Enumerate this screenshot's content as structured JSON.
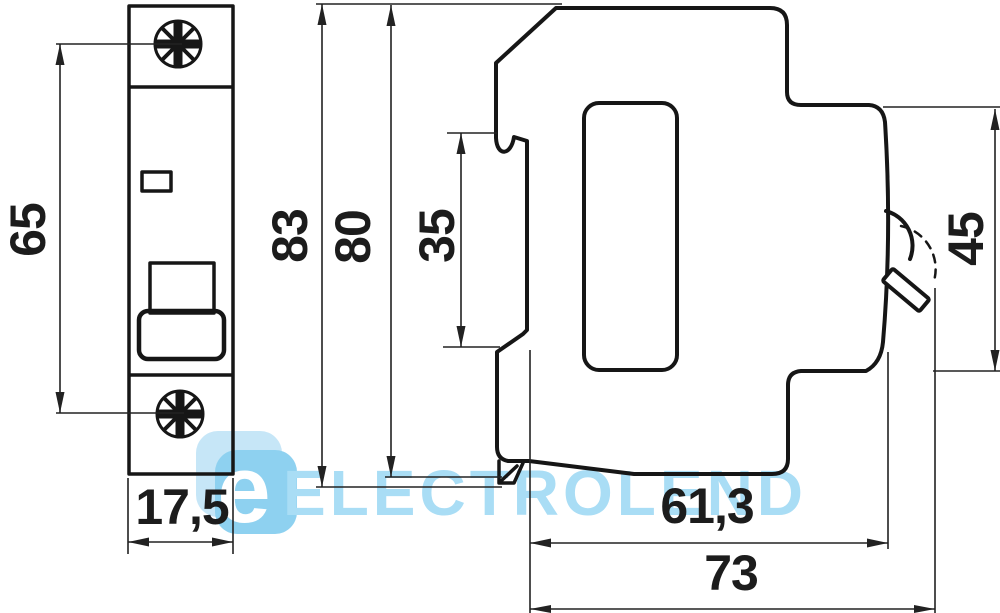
{
  "drawing": {
    "kind": "technical-dimension-drawing",
    "views": [
      "front-view",
      "side-view"
    ]
  },
  "dimensions": {
    "screw_spacing": {
      "label": "65"
    },
    "front_width": {
      "label": "17,5"
    },
    "overall_height": {
      "label": "83"
    },
    "body_height": {
      "label": "80"
    },
    "din_recess": {
      "label": "35"
    },
    "front_depth": {
      "label": "45"
    },
    "body_depth": {
      "label": "61,3"
    },
    "overall_depth": {
      "label": "73"
    }
  },
  "watermark": {
    "logo_letter": "e",
    "brand": "ELECTROLEND"
  },
  "colors": {
    "background": "#ffffff",
    "line": "#161616",
    "dim_line": "#222222",
    "dim_text": "#1c1c1c",
    "watermark_text": "#a9ddf5",
    "logo_tile_light": "#c6e6f7",
    "logo_tile_dark": "#8ed1f0",
    "logo_letter_color": "#ffffff"
  }
}
